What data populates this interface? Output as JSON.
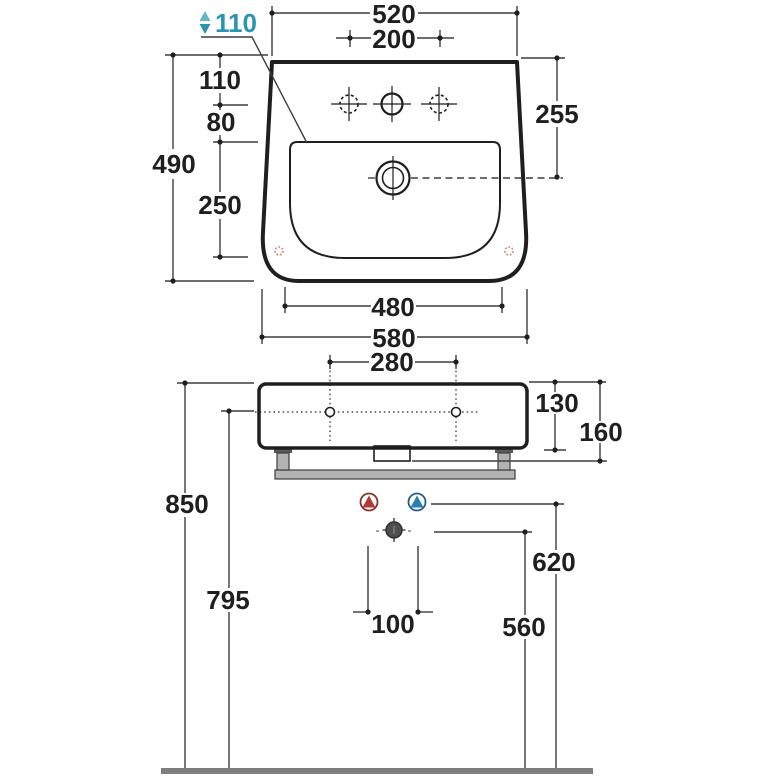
{
  "colors": {
    "line": "#1f1f1f",
    "dimension_line": "#3d3d3d",
    "accent_teal": "#2a95b0",
    "hot_red": "#b03a34",
    "hot_ring": "#8a2f2a",
    "cold_blue": "#2c7fb5",
    "cold_ring": "#1e5f8e",
    "waste_gray": "#4f4f4f",
    "optional_hole_red": "#d07b72",
    "metal_gray": "#b3b3b3",
    "bracket_dark": "#595959",
    "floor_gray": "#7f7f7f"
  },
  "front_view": {
    "dims": {
      "overall_width": "520",
      "tap_hole_spacing": "200",
      "ledge_note": "110",
      "rim_to_tap_holes": "110",
      "tap_holes_to_basin": "80",
      "overall_height": "490",
      "basin_inner_depth": "250",
      "rim_to_drain": "255",
      "basin_inner_width": "480",
      "base_width": "580"
    },
    "icons": {
      "ledge_note_icon": "updown-arrow-icon",
      "tap_holes": [
        "optional-tap-hole-icon",
        "tap-hole-icon",
        "optional-tap-hole-icon"
      ],
      "drain": "drain-hole-icon",
      "corner_marks": "optional-fixing-mark-icon"
    }
  },
  "installation_view": {
    "dims": {
      "fixing_hole_spacing": "280",
      "body_depth": "130",
      "body_with_bracket": "160",
      "rim_height": "850",
      "fixing_hole_height": "795",
      "supply_height": "620",
      "waste_height": "560",
      "supply_spacing": "100"
    },
    "icons": {
      "hot": "hot-water-icon",
      "cold": "cold-water-icon",
      "waste": "waste-outlet-icon",
      "floor": "floor-line"
    }
  }
}
